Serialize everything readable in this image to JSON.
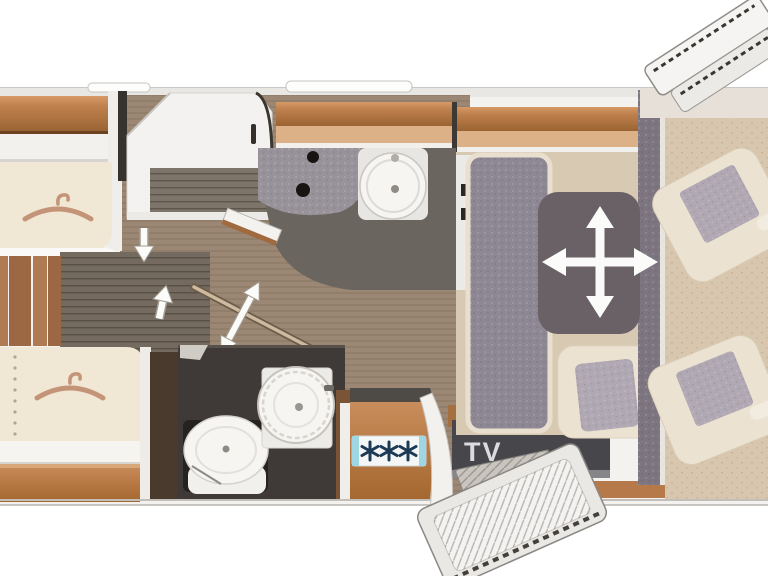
{
  "floorplan": {
    "type": "motorhome-top-view",
    "tv_label": "TV",
    "kitchen": {
      "burner_count": 3
    },
    "colors": {
      "wood": "#b5794a",
      "wood-light": "#d9ad85",
      "bed": "#f1e7d5",
      "floor-mid": "#9b8773",
      "floor-dark": "#746a5f",
      "bath-floor": "#6b655f",
      "room-dark": "#3f3a37",
      "upholstery": "#8e8794",
      "table": "#696165",
      "seat-beige": "#ece2d1",
      "cushion": "#b0a8b3",
      "tv-panel": "#47474b",
      "hob-teal": "#9fd6e4",
      "burner": "#1c3a55",
      "hanger": "#c49478",
      "arrow": "#fbfbfa",
      "white-fixture": "#f6f5f2"
    },
    "icons": [
      {
        "name": "hanger-icon",
        "area": "rear-bed-top"
      },
      {
        "name": "hanger-icon",
        "area": "rear-bed-bottom"
      },
      {
        "name": "arrow-down-icon",
        "area": "rear-bed-top-access"
      },
      {
        "name": "arrow-up-icon",
        "area": "rear-bed-bottom-access"
      },
      {
        "name": "double-arrow-icon",
        "area": "bathroom-sliding-door"
      },
      {
        "name": "move-cross-icon",
        "area": "dinette-table"
      },
      {
        "name": "burner-star-icon",
        "area": "kitchen-hob"
      }
    ]
  }
}
